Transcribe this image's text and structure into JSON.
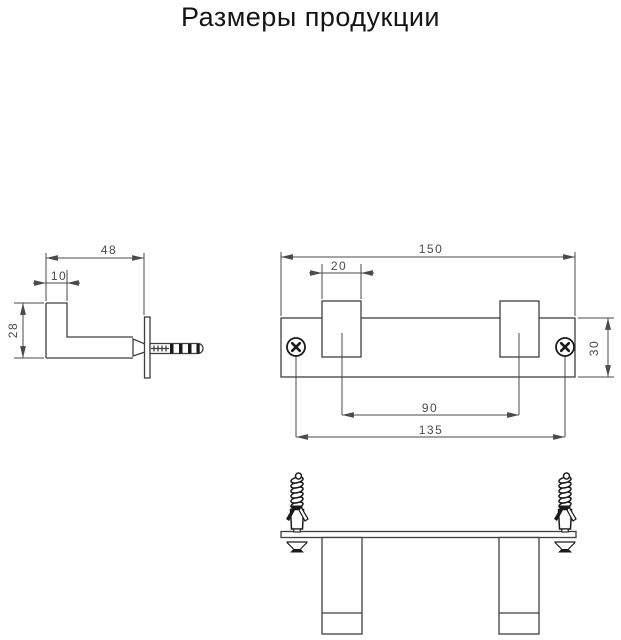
{
  "title": "Размеры продукции",
  "views": {
    "side": {
      "dims": {
        "depth": "48",
        "hook_offset": "10",
        "height": "28"
      }
    },
    "front": {
      "dims": {
        "total_width": "150",
        "hook_width": "20",
        "bar_height": "30",
        "hook_spacing": "90",
        "hole_spacing": "135"
      }
    }
  },
  "colors": {
    "background": "#ffffff",
    "object_line": "#3f3f3f",
    "dimension_line": "#4a4a4a",
    "title_text": "#141414",
    "hardware_dark": "#1a1a1a"
  }
}
